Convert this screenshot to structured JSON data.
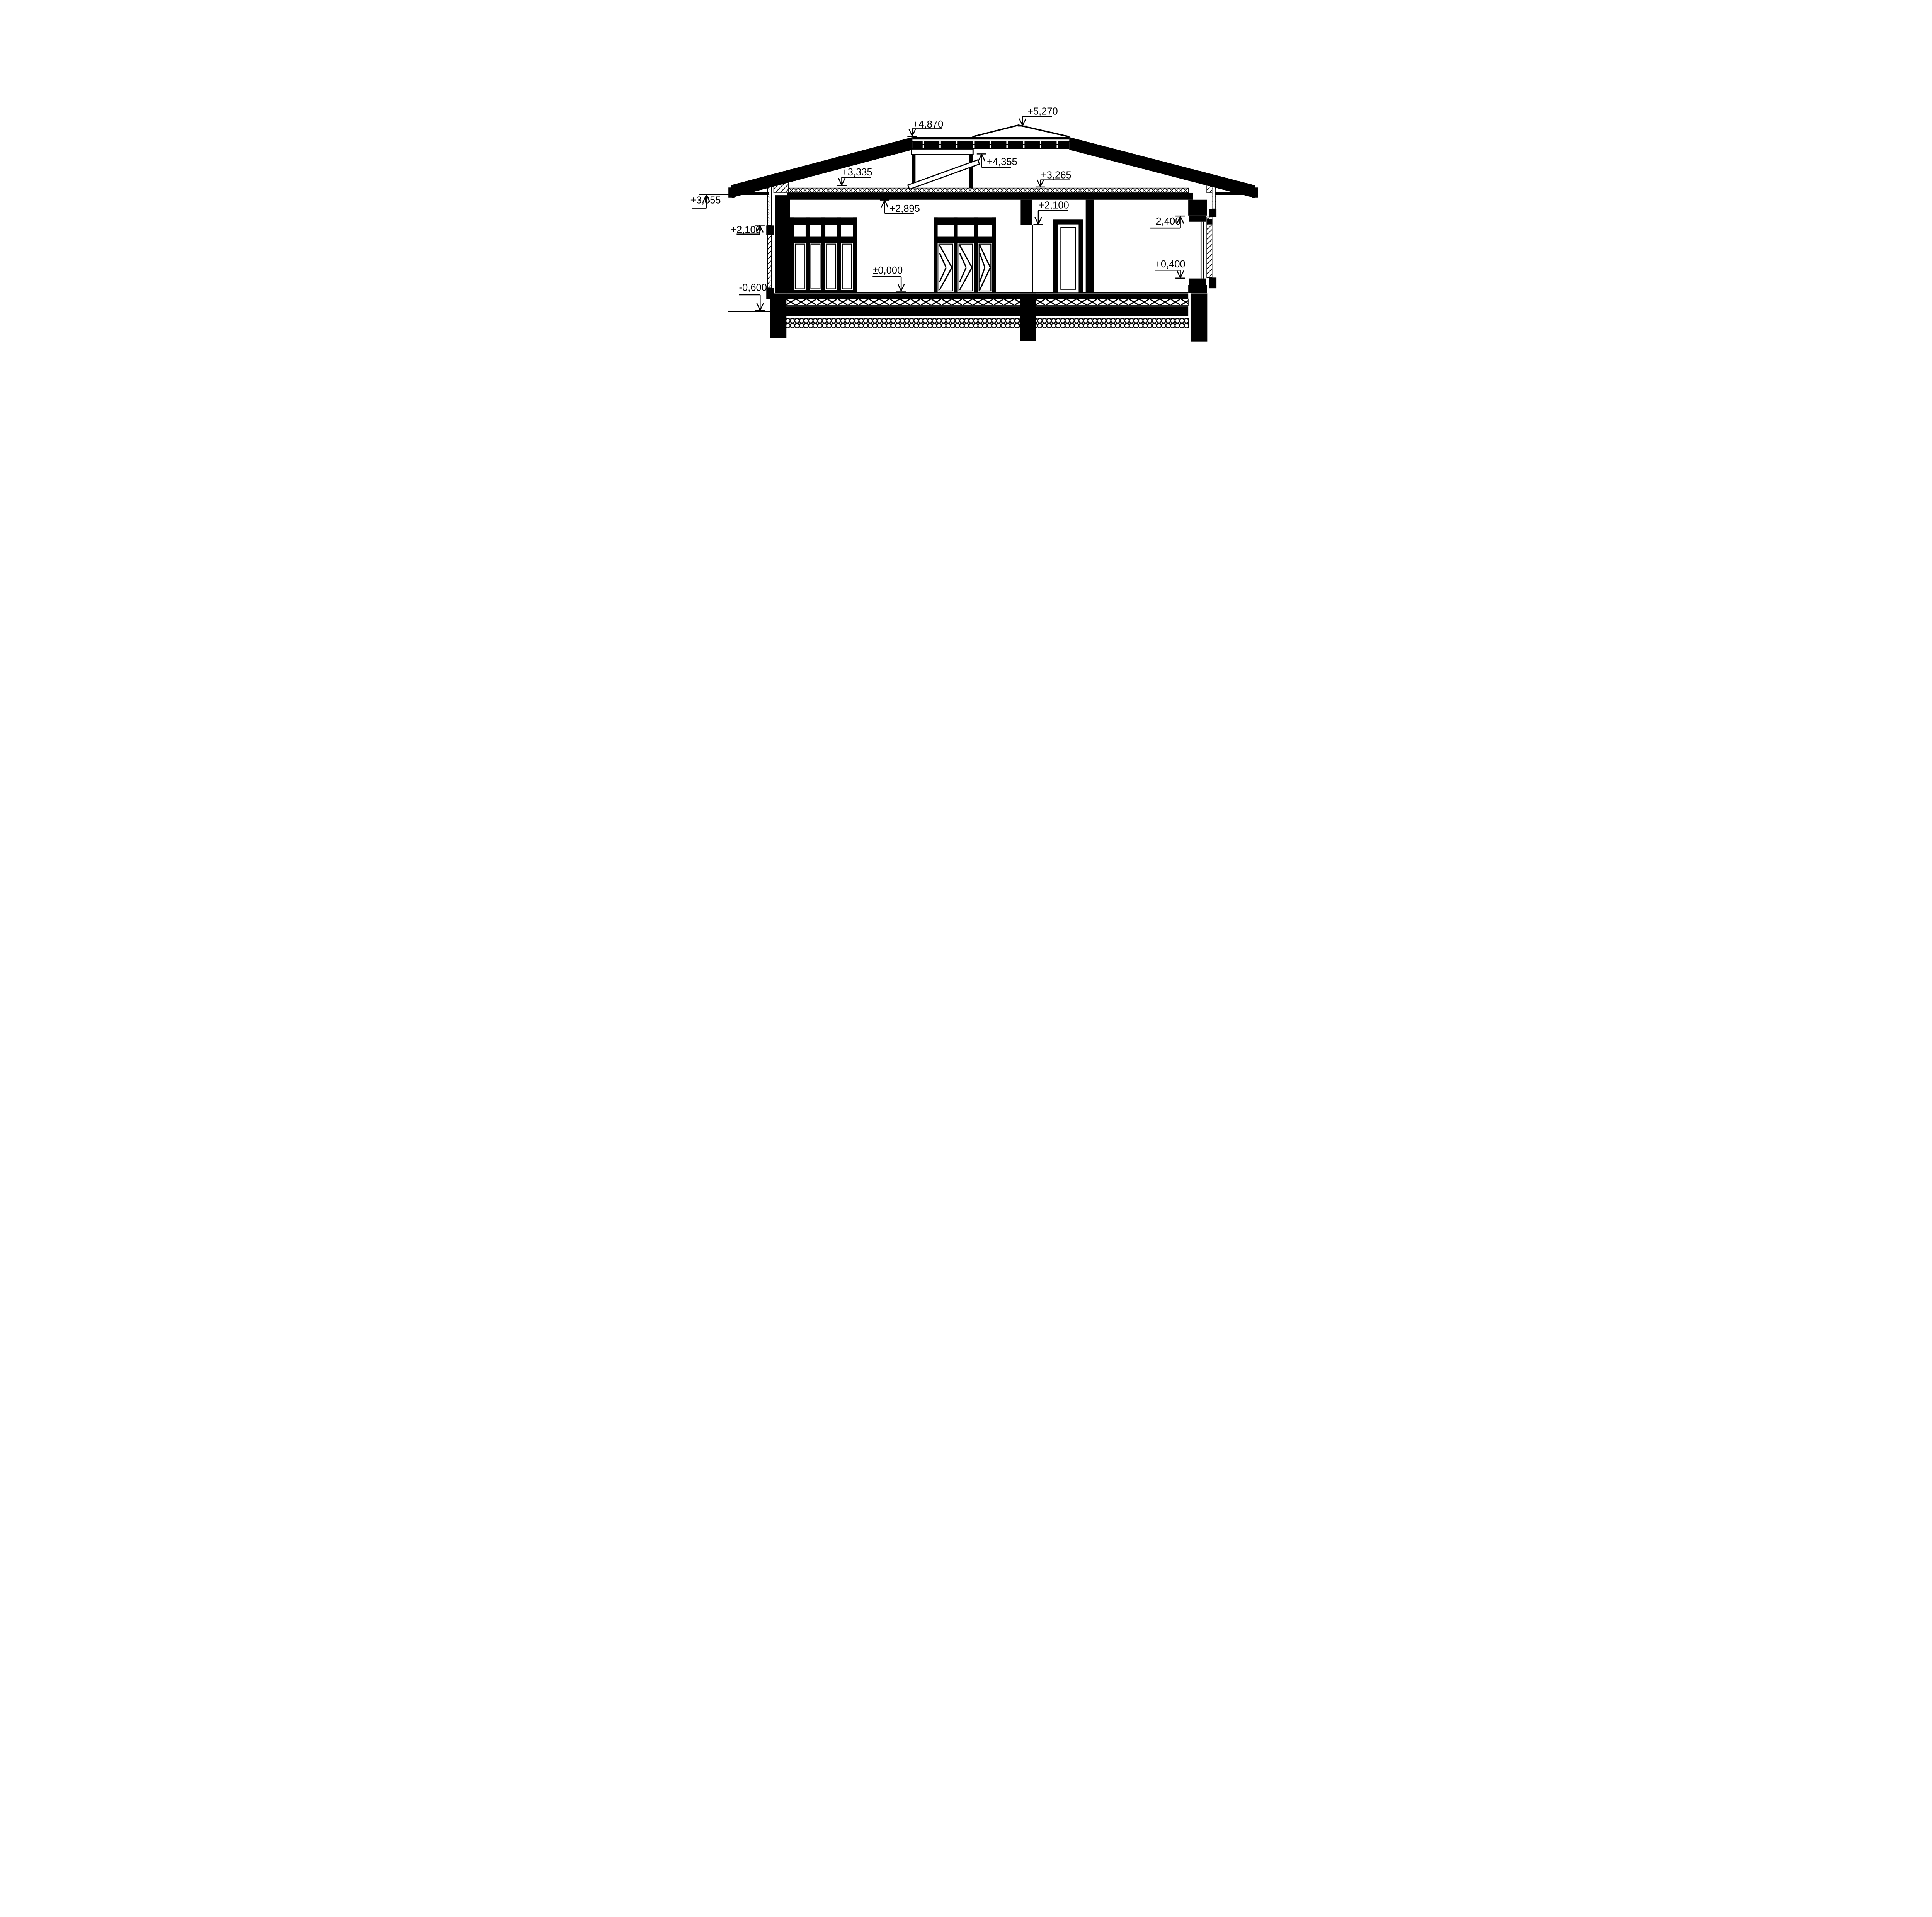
{
  "sheet": {
    "kind": "architectural cross-section drawing of a single-storey house",
    "background": "#ffffff",
    "ink_color": "#000000"
  },
  "annotations": [
    {
      "text": "+5,270",
      "target": "roof ridge apex",
      "arrow": "down"
    },
    {
      "text": "+4,870",
      "target": "top of flat roof section",
      "arrow": "down"
    },
    {
      "text": "+4,355",
      "target": "underside of roof hatch header",
      "arrow": "up"
    },
    {
      "text": "+3,335",
      "target": "top of ceiling insulation left",
      "arrow": "down"
    },
    {
      "text": "+3,265",
      "target": "top of ceiling insulation right",
      "arrow": "down"
    },
    {
      "text": "+3,055",
      "target": "underside of eave soffit",
      "arrow": "up"
    },
    {
      "text": "+2,895",
      "target": "underside of ceiling slab",
      "arrow": "up"
    },
    {
      "text": "+2,100",
      "target": "left window lintel",
      "arrow": "up"
    },
    {
      "text": "+2,100",
      "target": "interior door opening head",
      "arrow": "down"
    },
    {
      "text": "+2,400",
      "target": "right window head",
      "arrow": "up"
    },
    {
      "text": "+0,400",
      "target": "right window sill",
      "arrow": "down"
    },
    {
      "text": "±0,000",
      "target": "finished floor level",
      "arrow": "down"
    },
    {
      "text": "-0,600",
      "target": "exterior grade line",
      "arrow": "down"
    }
  ]
}
